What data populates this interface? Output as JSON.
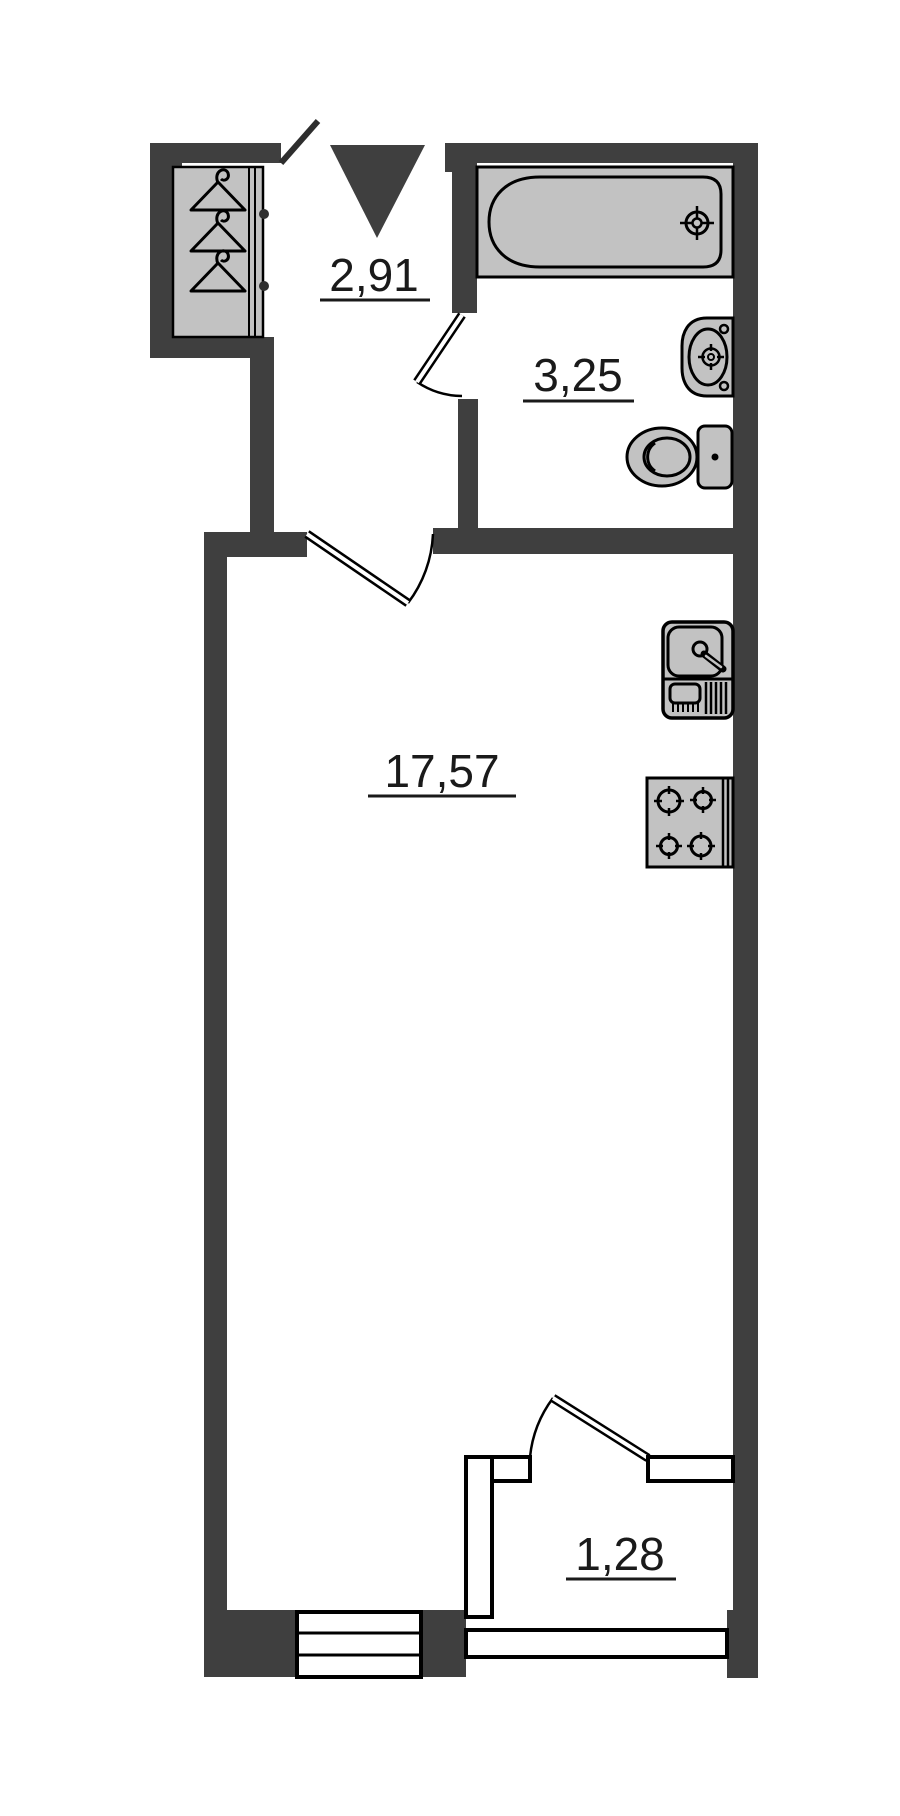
{
  "plan": {
    "rooms": {
      "hallway": {
        "area": "2,91"
      },
      "bathroom": {
        "area": "3,25"
      },
      "living_room": {
        "area": "17,57"
      },
      "balcony": {
        "area": "1,28"
      }
    },
    "colors": {
      "wall": "#3f3f3f",
      "fixture_fill": "#c2c2c2",
      "outline": "#000000",
      "label": "#1a1a1a",
      "background": "#ffffff"
    },
    "fixtures": [
      "wardrobe",
      "hanger",
      "bathtub",
      "wash-basin",
      "toilet",
      "kitchen-sink",
      "stove"
    ],
    "markers": {
      "entrance": "entrance-arrow"
    }
  }
}
